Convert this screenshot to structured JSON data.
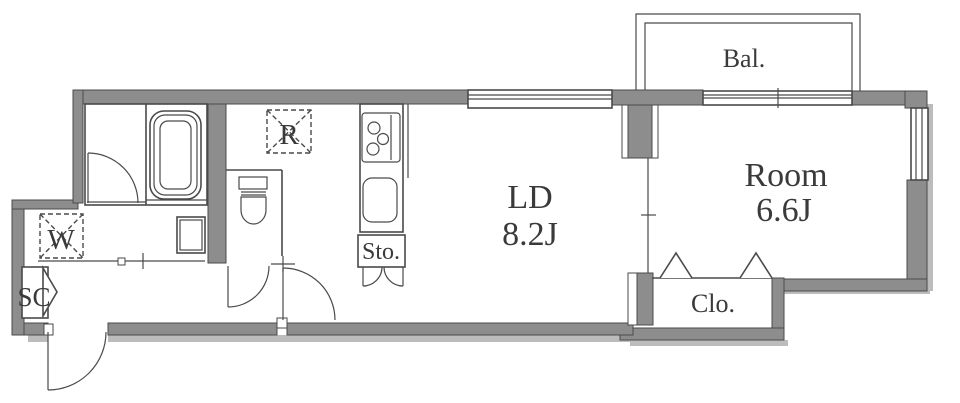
{
  "colors": {
    "wall": "#8d8d8d",
    "line": "#4a4a4a",
    "shadow": "#bcbcbc",
    "text": "#3a3a3a",
    "bg": "#ffffff"
  },
  "labels": {
    "balcony": "Bal.",
    "room": "Room",
    "room_size": "6.6J",
    "living": "LD",
    "living_size": "8.2J",
    "closet": "Clo.",
    "storage": "Sto.",
    "shoe_cabinet": "SC",
    "washer": "W",
    "refrigerator": "R"
  }
}
